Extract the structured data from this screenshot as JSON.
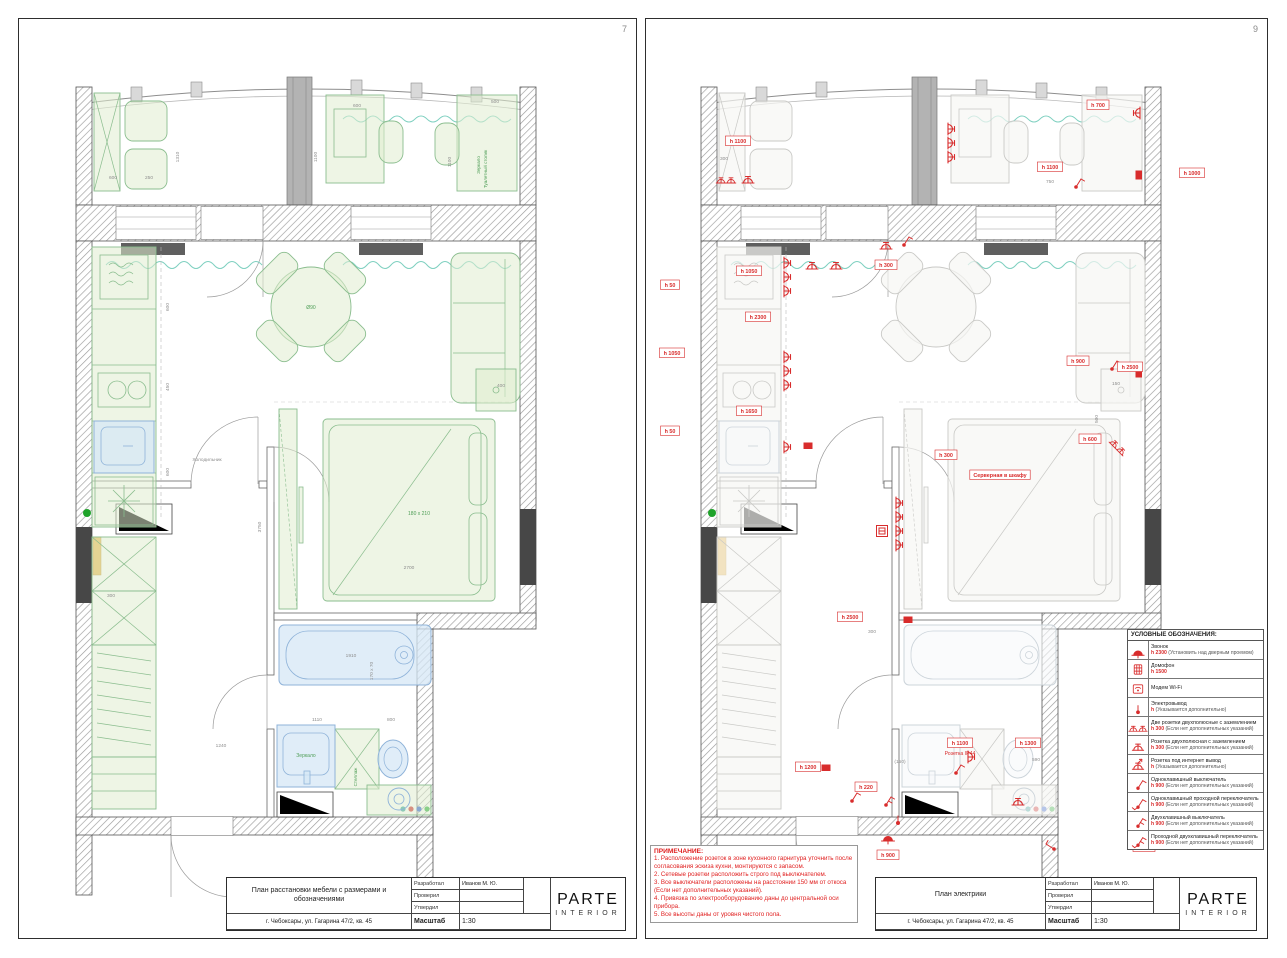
{
  "left_page": {
    "page_number": "7",
    "title_block": {
      "title": "План расстановки мебели  с размерами и обозначениями",
      "address": "г. Чебоксары, ул. Гагарина 47/2, кв. 45",
      "developed_label": "Разработал",
      "developed_value": "Иванов М. Ю.",
      "checked_label": "Проверил",
      "approved_label": "Утвердил",
      "scale_label": "Масштаб",
      "scale_value": "1:30",
      "brand": "PARTE",
      "brand_sub": "INTERIOR"
    },
    "plan_labels": [
      {
        "t": "500",
        "x": 474,
        "y": 46,
        "k": "d"
      },
      {
        "t": "1100",
        "x": 430,
        "y": 105,
        "k": "dv"
      },
      {
        "t": "Зеркало",
        "x": 459,
        "y": 108,
        "k": "v"
      },
      {
        "t": "Туалетный столик",
        "x": 466,
        "y": 112,
        "k": "v"
      },
      {
        "t": "600",
        "x": 336,
        "y": 50,
        "k": "d"
      },
      {
        "t": "1100",
        "x": 296,
        "y": 100,
        "k": "dv"
      },
      {
        "t": "600",
        "x": 92,
        "y": 122,
        "k": "d"
      },
      {
        "t": "250",
        "x": 128,
        "y": 122,
        "k": "d"
      },
      {
        "t": "1310",
        "x": 158,
        "y": 100,
        "k": "dv"
      },
      {
        "t": "Ø90",
        "x": 290,
        "y": 252,
        "k": "g"
      },
      {
        "t": "600",
        "x": 148,
        "y": 250,
        "k": "dv"
      },
      {
        "t": "450",
        "x": 148,
        "y": 330,
        "k": "dv"
      },
      {
        "t": "600",
        "x": 148,
        "y": 415,
        "k": "dv"
      },
      {
        "t": "Холодильник",
        "x": 186,
        "y": 404,
        "k": "d"
      },
      {
        "t": "180 x 210",
        "x": 398,
        "y": 458,
        "k": "g"
      },
      {
        "t": "2700",
        "x": 388,
        "y": 512,
        "k": "d"
      },
      {
        "t": "3750",
        "x": 240,
        "y": 470,
        "k": "dv"
      },
      {
        "t": "400",
        "x": 480,
        "y": 330,
        "k": "d"
      },
      {
        "t": "1910",
        "x": 330,
        "y": 600,
        "k": "d"
      },
      {
        "t": "170 x 70",
        "x": 352,
        "y": 614,
        "k": "dv"
      },
      {
        "t": "1110",
        "x": 296,
        "y": 664,
        "k": "d"
      },
      {
        "t": "800",
        "x": 370,
        "y": 664,
        "k": "d"
      },
      {
        "t": "1240",
        "x": 200,
        "y": 690,
        "k": "d"
      },
      {
        "t": "Зеркало",
        "x": 285,
        "y": 700,
        "k": "g"
      },
      {
        "t": "Стеллаж",
        "x": 336,
        "y": 720,
        "k": "v"
      },
      {
        "t": "300",
        "x": 90,
        "y": 540,
        "k": "d"
      }
    ]
  },
  "right_page": {
    "page_number": "9",
    "title_block": {
      "title": "План электрики",
      "address": "г. Чебоксары, ул. Гагарина 47/2, кв. 45",
      "developed_label": "Разработал",
      "developed_value": "Иванов М. Ю.",
      "checked_label": "Проверил",
      "approved_label": "Утвердил",
      "scale_label": "Масштаб",
      "scale_value": "1:30",
      "brand": "PARTE",
      "brand_sub": "INTERIOR"
    },
    "legend": {
      "title": "УСЛОВНЫЕ ОБОЗНАЧЕНИЯ:",
      "items": [
        {
          "icon": "bell",
          "name": "Звонок",
          "h": "h 2300",
          "note": "(Установить над дверным проемом)"
        },
        {
          "icon": "intercom",
          "name": "Домофон",
          "h": "h 1500",
          "note": ""
        },
        {
          "icon": "modem",
          "name": "Модем Wi-Fi",
          "h": "",
          "note": ""
        },
        {
          "icon": "electro",
          "name": "Электровывод",
          "h": "h",
          "note": "(Указывается дополнительно)"
        },
        {
          "icon": "socket2",
          "name": "Две розетки двухполюсные с заземлением",
          "h": "h 300",
          "note": "(Если нет дополнительных указаний)"
        },
        {
          "icon": "socket",
          "name": "Розетка двухполюсная с заземлением",
          "h": "h 300",
          "note": "(Если нет дополнительных указаний)"
        },
        {
          "icon": "socketnet",
          "name": "Розетка под интернет вывод",
          "h": "h",
          "note": "(Указывается дополнительно)"
        },
        {
          "icon": "switch1",
          "name": "Одноклавишный выключатель",
          "h": "h 900",
          "note": "(Если нет дополнительных указаний)"
        },
        {
          "icon": "switch1p",
          "name": "Одноклавишный проходной переключатель",
          "h": "h 900",
          "note": "(Если нет дополнительных указаний)"
        },
        {
          "icon": "switch2",
          "name": "Двухклавишный выключатель",
          "h": "h 900",
          "note": "(Если нет дополнительных указаний)"
        },
        {
          "icon": "switch2p",
          "name": "Проходной двухклавишный переключатель",
          "h": "h 900",
          "note": "(Если нет дополнительных указаний)"
        }
      ]
    },
    "notes": {
      "title": "ПРИМЕЧАНИЕ:",
      "lines": [
        "1. Расположение розеток в зоне кухонного гарнитура уточнить после согласования эскиза кухни, монтируются с запасом.",
        "2. Сетевые розетки расположить строго под выключателем.",
        "3. Все выключатели расположены на расстоянии 150 мм от откоса (Если нет дополнительных указаний).",
        "4. Привязка по электрооборудованию даны до центральной оси прибора.",
        "5. Все высоты даны от уровня чистого пола."
      ]
    },
    "plan_labels": [
      {
        "t": "h 1100",
        "x": 92,
        "y": 86,
        "k": "r"
      },
      {
        "t": "300",
        "x": 78,
        "y": 103,
        "k": "d"
      },
      {
        "t": "h 700",
        "x": 452,
        "y": 50,
        "k": "r"
      },
      {
        "t": "h 1100",
        "x": 404,
        "y": 112,
        "k": "r"
      },
      {
        "t": "750",
        "x": 404,
        "y": 126,
        "k": "d"
      },
      {
        "t": "h 1000",
        "x": 546,
        "y": 118,
        "k": "r"
      },
      {
        "t": "h 1050",
        "x": 103,
        "y": 216,
        "k": "r"
      },
      {
        "t": "h 50",
        "x": 24,
        "y": 230,
        "k": "r"
      },
      {
        "t": "h 2300",
        "x": 112,
        "y": 262,
        "k": "r"
      },
      {
        "t": "h 1050",
        "x": 26,
        "y": 298,
        "k": "r"
      },
      {
        "t": "h 300",
        "x": 240,
        "y": 210,
        "k": "r"
      },
      {
        "t": "h 1650",
        "x": 103,
        "y": 356,
        "k": "r"
      },
      {
        "t": "h 50",
        "x": 24,
        "y": 376,
        "k": "r"
      },
      {
        "t": "h 900",
        "x": 432,
        "y": 306,
        "k": "r"
      },
      {
        "t": "h 2500",
        "x": 484,
        "y": 312,
        "k": "r"
      },
      {
        "t": "150",
        "x": 470,
        "y": 328,
        "k": "d"
      },
      {
        "t": "500",
        "x": 452,
        "y": 362,
        "k": "dv"
      },
      {
        "t": "h 600",
        "x": 444,
        "y": 384,
        "k": "r"
      },
      {
        "t": "h 300",
        "x": 300,
        "y": 400,
        "k": "r"
      },
      {
        "t": "Серверная в шкафу",
        "x": 354,
        "y": 420,
        "k": "r"
      },
      {
        "t": "h 2500",
        "x": 204,
        "y": 562,
        "k": "r"
      },
      {
        "t": "300",
        "x": 226,
        "y": 576,
        "k": "d"
      },
      {
        "t": "h 1200",
        "x": 162,
        "y": 712,
        "k": "r"
      },
      {
        "t": "h 220",
        "x": 220,
        "y": 732,
        "k": "r"
      },
      {
        "t": "(150)",
        "x": 254,
        "y": 706,
        "k": "d"
      },
      {
        "t": "h 1100",
        "x": 314,
        "y": 688,
        "k": "r"
      },
      {
        "t": "Розетка IP44",
        "x": 314,
        "y": 698,
        "k": "rt"
      },
      {
        "t": "h 1300",
        "x": 382,
        "y": 688,
        "k": "r"
      },
      {
        "t": "590",
        "x": 390,
        "y": 704,
        "k": "d"
      },
      {
        "t": "h 900",
        "x": 242,
        "y": 800,
        "k": "r"
      },
      {
        "t": "h 900",
        "x": 498,
        "y": 792,
        "k": "r"
      }
    ],
    "symbols": [
      {
        "t": "s2",
        "x": 80,
        "y": 126
      },
      {
        "t": "s",
        "x": 102,
        "y": 126
      },
      {
        "t": "s",
        "x": 302,
        "y": 72,
        "r": 90
      },
      {
        "t": "s",
        "x": 302,
        "y": 86,
        "r": 90
      },
      {
        "t": "s",
        "x": 302,
        "y": 100,
        "r": 90
      },
      {
        "t": "s",
        "x": 494,
        "y": 56,
        "r": -90
      },
      {
        "t": "w1",
        "x": 430,
        "y": 130
      },
      {
        "t": "t",
        "x": 496,
        "y": 118,
        "r": -90
      },
      {
        "t": "s",
        "x": 138,
        "y": 206,
        "r": 90
      },
      {
        "t": "s",
        "x": 138,
        "y": 220,
        "r": 90
      },
      {
        "t": "s",
        "x": 138,
        "y": 234,
        "r": 90
      },
      {
        "t": "s",
        "x": 166,
        "y": 212
      },
      {
        "t": "s",
        "x": 190,
        "y": 212
      },
      {
        "t": "s",
        "x": 138,
        "y": 300,
        "r": 90
      },
      {
        "t": "s",
        "x": 138,
        "y": 314,
        "r": 90
      },
      {
        "t": "s",
        "x": 138,
        "y": 328,
        "r": 90
      },
      {
        "t": "s",
        "x": 138,
        "y": 390,
        "r": 90
      },
      {
        "t": "t",
        "x": 162,
        "y": 392
      },
      {
        "t": "s",
        "x": 240,
        "y": 192
      },
      {
        "t": "w1",
        "x": 258,
        "y": 188
      },
      {
        "t": "w1",
        "x": 466,
        "y": 312
      },
      {
        "t": "t",
        "x": 496,
        "y": 316,
        "r": -90
      },
      {
        "t": "s2",
        "x": 470,
        "y": 392,
        "r": 45
      },
      {
        "t": "s",
        "x": 250,
        "y": 446,
        "r": 90
      },
      {
        "t": "s",
        "x": 250,
        "y": 460,
        "r": 90
      },
      {
        "t": "s",
        "x": 250,
        "y": 474,
        "r": 90
      },
      {
        "t": "s",
        "x": 250,
        "y": 488,
        "r": 90
      },
      {
        "t": "v",
        "x": 236,
        "y": 474
      },
      {
        "t": "t",
        "x": 262,
        "y": 566
      },
      {
        "t": "t",
        "x": 180,
        "y": 714
      },
      {
        "t": "w1",
        "x": 206,
        "y": 744
      },
      {
        "t": "w2",
        "x": 240,
        "y": 748
      },
      {
        "t": "b",
        "x": 242,
        "y": 784
      },
      {
        "t": "w1",
        "x": 310,
        "y": 716
      },
      {
        "t": "s",
        "x": 322,
        "y": 700,
        "r": 90
      },
      {
        "t": "s",
        "x": 372,
        "y": 748
      },
      {
        "t": "w1",
        "x": 408,
        "y": 792,
        "r": -90
      },
      {
        "t": "e",
        "x": 252,
        "y": 766
      }
    ]
  },
  "colors": {
    "furniture_green": "#8abd8e",
    "plumbing_blue": "#8fb3d9",
    "electric_red": "#d82c2c",
    "wall_dark": "#474747",
    "curtain_teal": "#7fd0c0"
  }
}
